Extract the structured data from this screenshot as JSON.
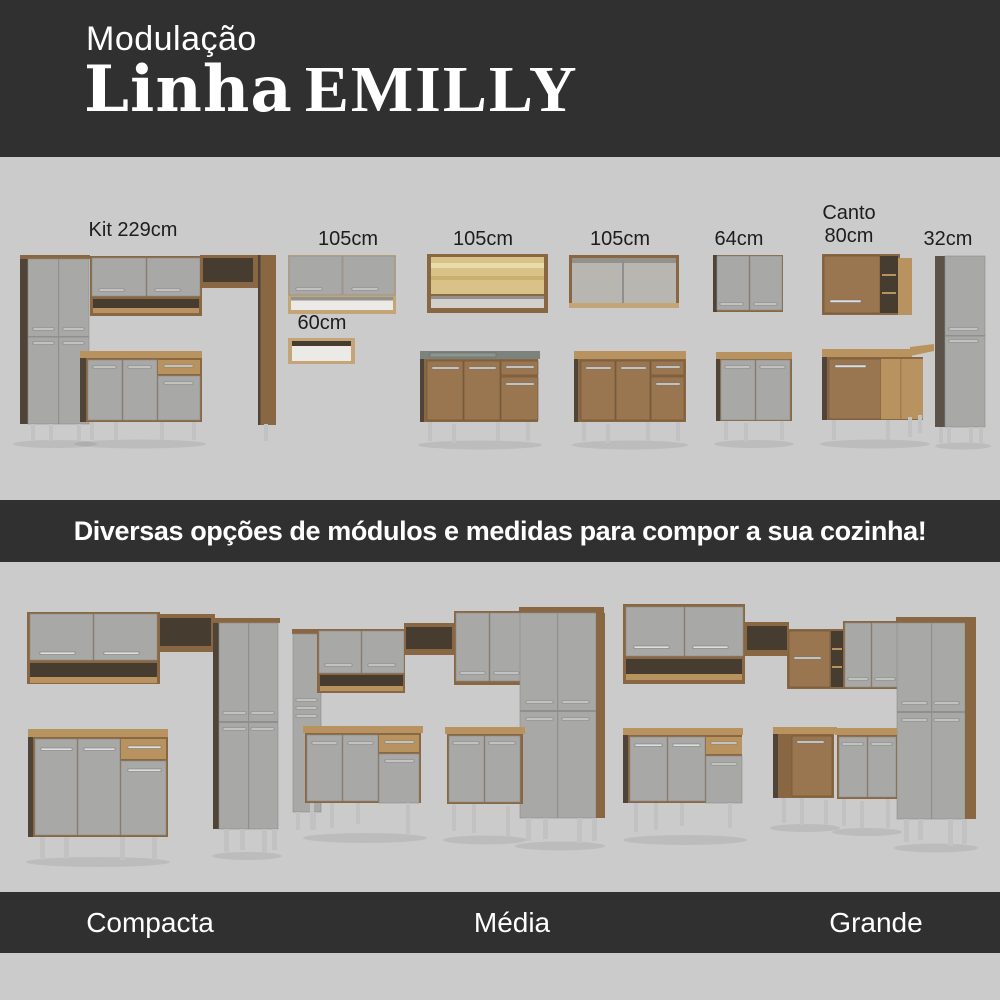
{
  "header": {
    "kicker": "Modulação",
    "title_line": "Linha",
    "title_collection": "EMILLY"
  },
  "modules": {
    "kit": "Kit 229cm",
    "wall_105_a": "105cm",
    "wall_105_b": "105cm",
    "wall_105_c": "105cm",
    "wall_64": "64cm",
    "canto_line1": "Canto",
    "canto_line2": "80cm",
    "tall_32": "32cm",
    "niche_60": "60cm"
  },
  "tagline": "Diversas opções de módulos e medidas para compor a sua cozinha!",
  "kitchen_sizes": {
    "compacta": "Compacta",
    "media": "Média",
    "grande": "Grande"
  },
  "colors": {
    "bg_dark": "#303030",
    "bg_light": "#cbcbcb",
    "door": "#a8a8a7",
    "wood": "#8a6743",
    "wood_grain": "#9a7650",
    "wood_light": "#b8935f",
    "wood_pale": "#c4a577",
    "wood_dark": "#4f4437",
    "niche": "#463c30",
    "interior": "#eceae7",
    "glass": "#d8c287",
    "glass_hi": "#e9dcab",
    "sink": "#7b837c",
    "handle": "#dedede",
    "handle_edge": "#6f6f6f",
    "leg": "#c2c2c2",
    "text_dark": "#1d1d1d",
    "text_light": "#ffffff"
  }
}
